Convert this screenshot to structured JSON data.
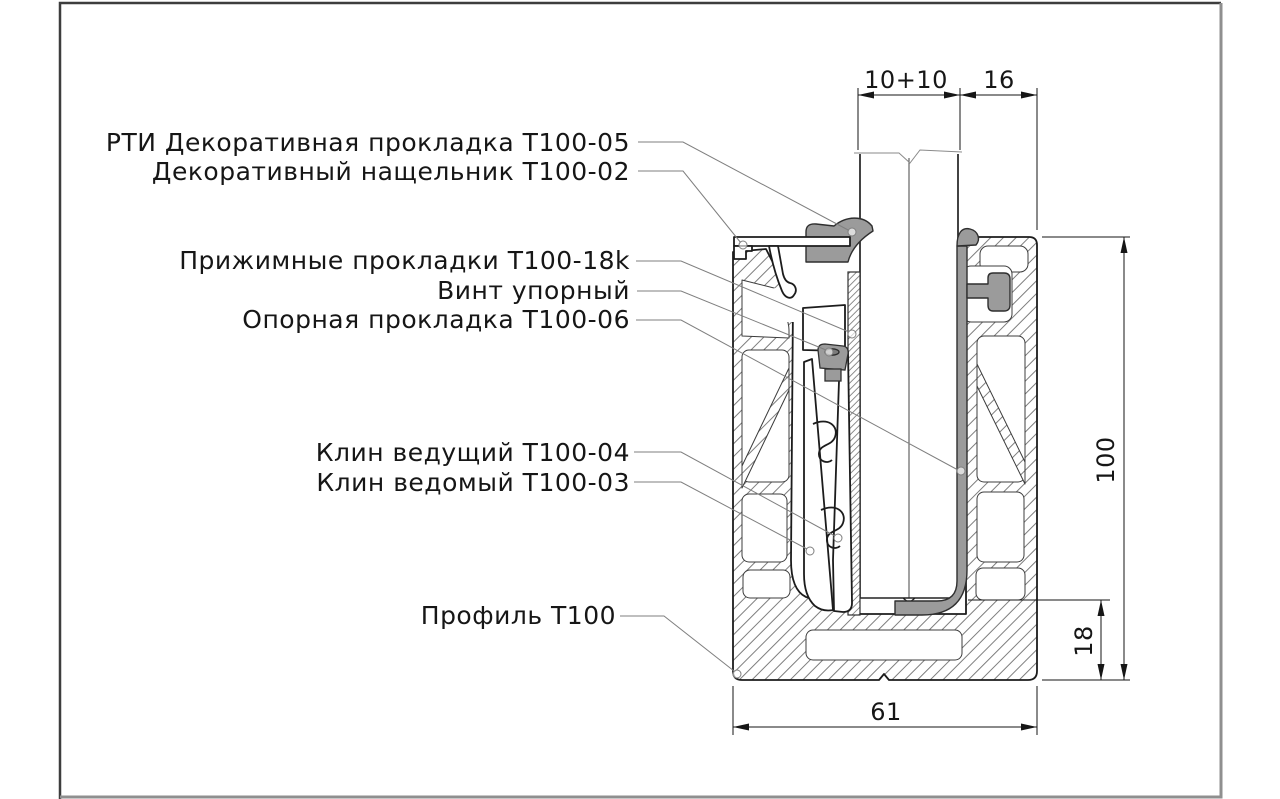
{
  "drawing": {
    "title_hint": "Cross-section of glass railing profile T100 (technical drawing)",
    "labels": {
      "rti_gasket": "РТИ Декоративная прокладка Т100-05",
      "cover_strip": "Декоративный нащельник Т100-02",
      "pressure_pads": "Прижимные прокладки Т100-18k",
      "stop_screw": "Винт упорный",
      "support_pad": "Опорная прокладка Т100-06",
      "driving_wedge": "Клин ведущий Т100-04",
      "driven_wedge": "Клин ведомый Т100-03",
      "profile": "Профиль Т100"
    },
    "dimensions": {
      "glass_thickness": "10+10",
      "top_gap": "16",
      "profile_height": "100",
      "base_height": "18",
      "profile_width": "61"
    },
    "colors": {
      "outline": "#1c1c1c",
      "hatch": "#6f6f6f",
      "leader": "#7f7f7f",
      "gasket_gray": "#9b9b9b",
      "frame_dark": "#3d3d3d",
      "frame_light": "#8f8f8f"
    }
  }
}
